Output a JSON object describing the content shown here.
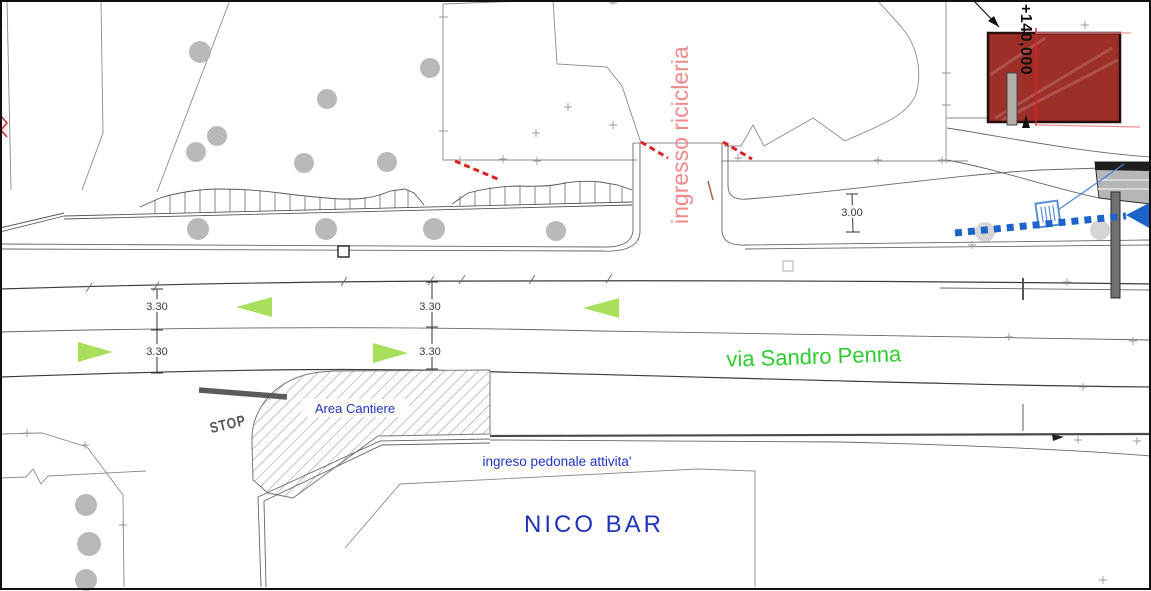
{
  "drawing": {
    "labels": {
      "street": "via Sandro Penna",
      "entrance": "ingresso ricicleria",
      "work_area": "Area Cantiere",
      "stop": "STOP",
      "pedestrian_entrance": "ingreso pedonale attivita'",
      "building": "NICO BAR",
      "elevation": "+140,000"
    },
    "dimensions": {
      "upper_lane_left": "3.30",
      "lower_lane_left": "3.30",
      "upper_lane_mid": "3.30",
      "lower_lane_mid": "3.30",
      "entrance_lane": "3.00"
    },
    "colors": {
      "street_label": "#2ecc2e",
      "blue_label": "#2233bb",
      "entrance_label": "#ee8a8a",
      "arrow_green": "#a8e05c",
      "route_blue": "#1e63c8",
      "building_red": "#9d2e28",
      "red_dash": "#dd2222",
      "stop_gray": "#565656"
    },
    "icons": {
      "tree": "circle-canopy",
      "lane_direction": "triangle-arrow",
      "vehicle_route": "dashed-line-arrow",
      "drain": "grate-square",
      "cross_marker": "plus",
      "stop_line": "thick-bar"
    }
  }
}
